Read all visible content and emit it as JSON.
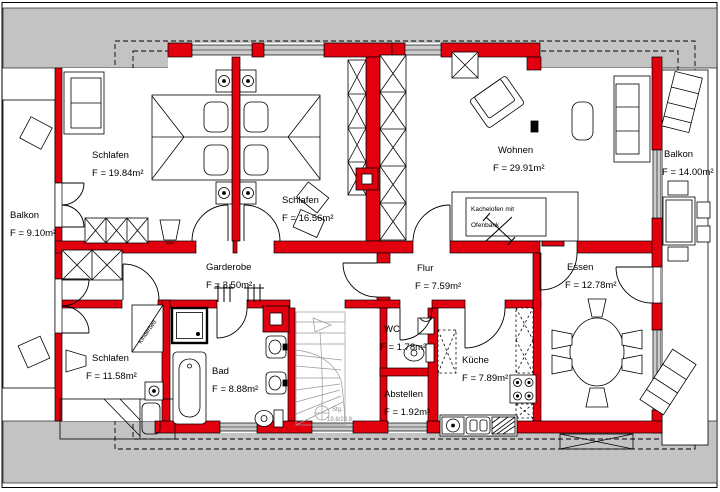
{
  "colors": {
    "wall_red": "#e2000f",
    "roof_gray": "#c3c3c3",
    "window_gray": "#cccccc",
    "stair_gray": "#999999",
    "paper_white": "#ffffff",
    "line_black": "#000000"
  },
  "rooms": {
    "schlafen_nw": {
      "name": "Schlafen",
      "area": "F = 19.84m²"
    },
    "schlafen_n": {
      "name": "Schlafen",
      "area": "F = 16.56m²"
    },
    "wohnen": {
      "name": "Wohnen",
      "area": "F = 29.91m²"
    },
    "balkon_west": {
      "name": "Balkon",
      "area": "F = 9.10m²"
    },
    "balkon_ost": {
      "name": "Balkon",
      "area": "F = 14.00m²"
    },
    "garderobe": {
      "name": "Garderobe",
      "area": "F = 3.50m²"
    },
    "flur": {
      "name": "Flur",
      "area": "F = 7.59m²"
    },
    "essen": {
      "name": "Essen",
      "area": "F = 12.78m²"
    },
    "schlafen_sw": {
      "name": "Schlafen",
      "area": "F = 11.58m²"
    },
    "bad": {
      "name": "Bad",
      "area": "F = 8.88m²"
    },
    "wc": {
      "name": "WC",
      "area": "F = 1.78m²"
    },
    "kueche": {
      "name": "Küche",
      "area": "F = 7.89m²"
    },
    "abstellen": {
      "name": "Abstellen",
      "area": "F = 1.92m²"
    }
  },
  "annotations": {
    "kachelofen_line1": "Kachelofen mit",
    "kachelofen_line2": "Ofenbank",
    "kinderbett": "Kinderbett",
    "stairs_line1": "Stg.",
    "stairs_line2": "19.6/23.8"
  }
}
